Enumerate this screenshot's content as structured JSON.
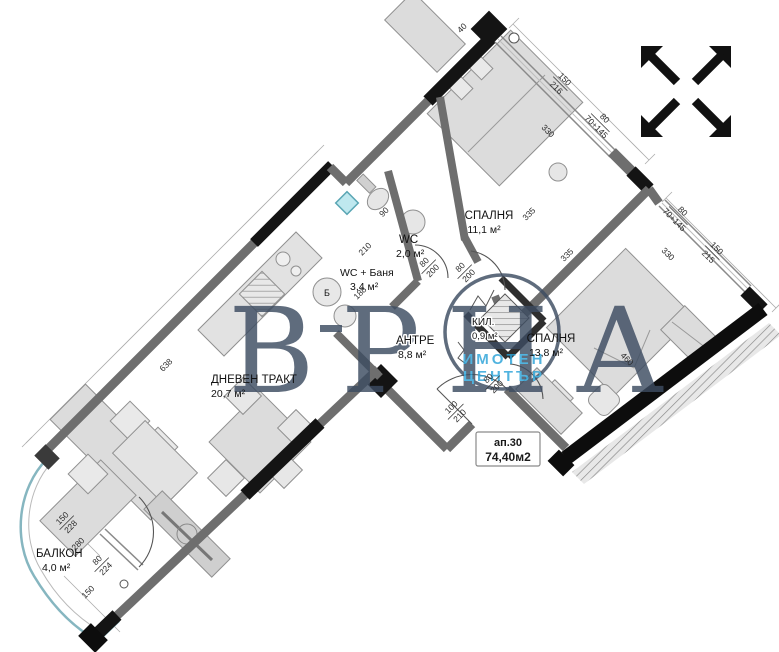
{
  "plan": {
    "unit_box": {
      "line1": "ап.30",
      "line2": "74,40м2"
    },
    "rooms": [
      {
        "name": "СПАЛНЯ",
        "area": "11,1 м²"
      },
      {
        "name": "СПАЛНЯ",
        "area": "13,8 м²"
      },
      {
        "name": "ДНЕВЕН ТРАКТ",
        "area": "20,7 м²"
      },
      {
        "name": "БАЛКОН",
        "area": "4,0 м²"
      },
      {
        "name": "АНТРЕ",
        "area": "8,8 м²"
      },
      {
        "name": "WC",
        "area": "2,0 м²"
      },
      {
        "name": "WC + Баня",
        "area": "3,4 м²"
      },
      {
        "name": "КИЛ.",
        "area": "0,9 м²"
      }
    ],
    "appliance_label": "Б",
    "dims": {
      "living_wall": "638",
      "b1_window": "330",
      "b1_frac_top": "150",
      "b1_frac_bot": "216",
      "b1_pier_top": "80",
      "b1_pier_bot": "70+145",
      "b2_window": "330",
      "b2_frac_top": "150",
      "b2_frac_bot": "215",
      "b2_pier_top": "80",
      "b2_pier_bot": "70+145",
      "int_335_a": "335",
      "int_335_b": "335",
      "bath_210": "210",
      "bath_188": "188",
      "wc_90": "90",
      "door_wc_top": "80",
      "door_wc_bot": "200",
      "door_b1_top": "80",
      "door_b1_bot": "200",
      "door_b2_top": "80",
      "door_b2_bot": "200",
      "entry_top": "100",
      "entry_bot": "210",
      "balc_door_top": "150",
      "balc_door_bot": "228",
      "balc_280": "280",
      "balc_win_top": "80",
      "balc_win_bot": "224",
      "balc_150": "150",
      "bed2_460": "460",
      "top_40": "40"
    },
    "watermark": {
      "main": "ВРНА",
      "line1": "ИМОТЕН",
      "line2": "ЦЕНТЪР"
    },
    "colors": {
      "wall": "#6e6e6e",
      "wall_dark": "#111111",
      "accent_blue": "#2ba3d8",
      "watermark": "#3d4c61",
      "balcony_rail": "#86b6c0",
      "furniture": "#dcdcdc"
    }
  }
}
